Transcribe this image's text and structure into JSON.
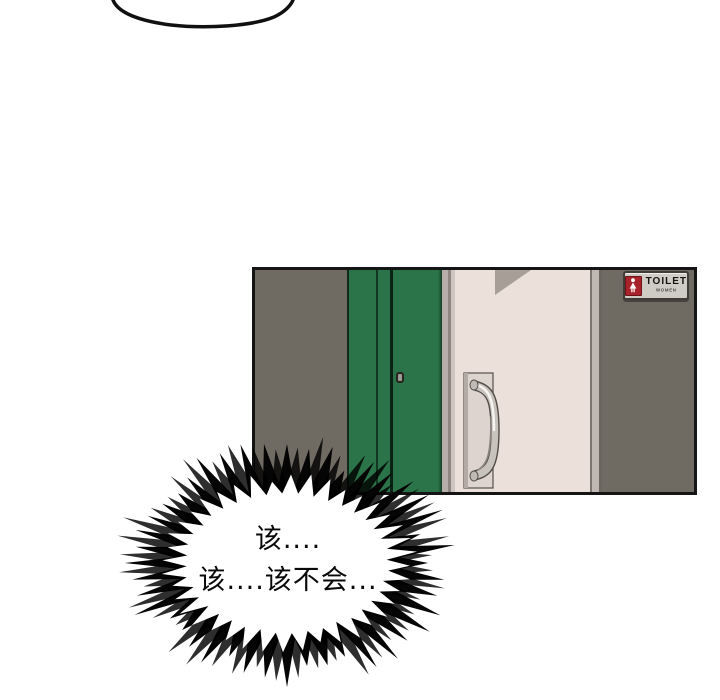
{
  "bubble": {
    "line1": "该....",
    "line2": "该....该不会..."
  },
  "sign": {
    "title": "TOILET",
    "subtitle": "WOMEN",
    "icon": "female-figure-icon"
  },
  "colors": {
    "ink": "#151515",
    "wall-gray": "#6f6a62",
    "door-green": "#2b7449",
    "door-beige": "#ece0db",
    "frame-light": "#b7aeaa",
    "frame-mid": "#8f8681",
    "beige-shadow": "#a79e98",
    "sign-bg": "#cfccc6",
    "sign-red": "#a8232b",
    "metal": "#c9c3bd",
    "metal-highlight": "#f7f5f2",
    "metal-dark": "#8a857f"
  }
}
